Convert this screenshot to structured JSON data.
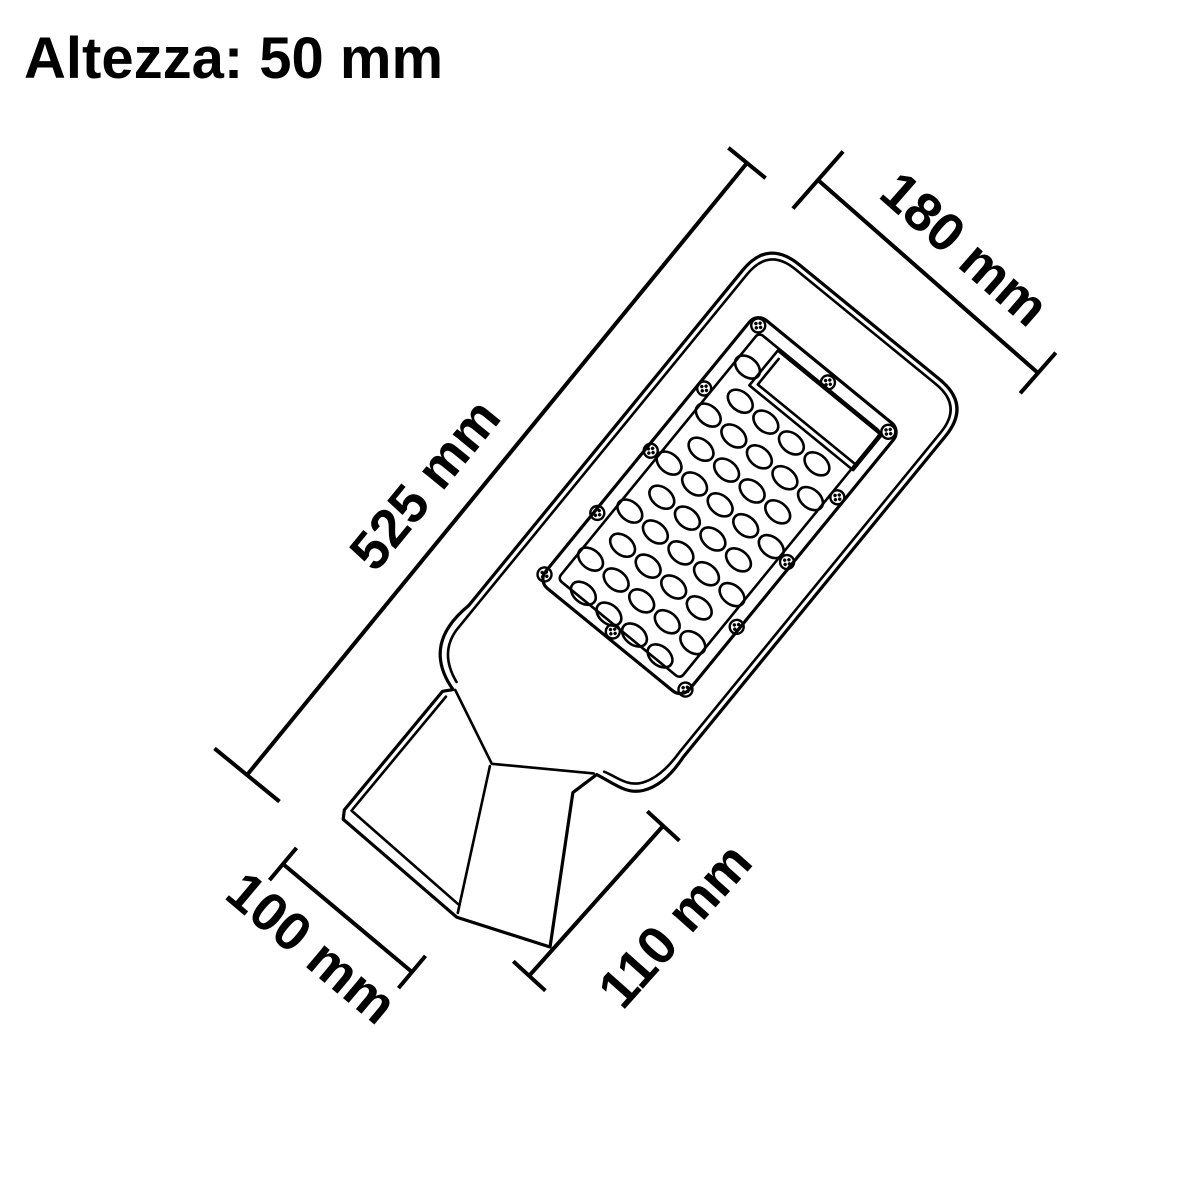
{
  "title": "Altezza: 50 mm",
  "diagram": {
    "subject": "LED street light technical dimension drawing",
    "dimensions": {
      "overall_length": "525 mm",
      "head_width": "180 mm",
      "mount_width": "100 mm",
      "mount_length": "110 mm"
    }
  },
  "colors": {
    "line": "#000000",
    "text": "#000000",
    "background": "#ffffff"
  }
}
